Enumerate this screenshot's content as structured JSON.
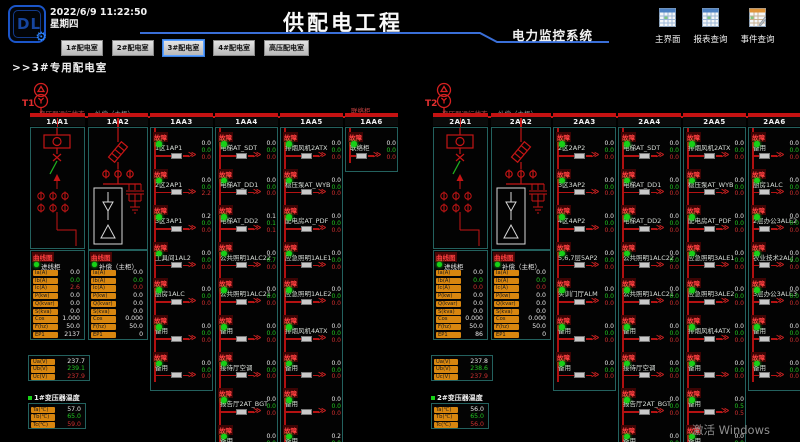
{
  "header": {
    "logo_text": "DL",
    "datetime": "2022/6/9 11:22:50",
    "weekday": "星期四",
    "title": "供配电工程",
    "subtitle": "电力监控系统",
    "nav_buttons": [
      {
        "label": "1#配电室",
        "active": false
      },
      {
        "label": "2#配电室",
        "active": false
      },
      {
        "label": "3#配电室",
        "active": true
      },
      {
        "label": "4#配电室",
        "active": false
      },
      {
        "label": "高压配电室",
        "active": false
      }
    ],
    "tool_buttons": [
      {
        "label": "主界面",
        "icon": "spreadsheet"
      },
      {
        "label": "报表查询",
        "icon": "spreadsheet"
      },
      {
        "label": "事件查询",
        "icon": "event-log"
      }
    ]
  },
  "breadcrumb": ">>3#专用配电室",
  "watermark": "激活 Windows",
  "status_labels": {
    "fault": "故障",
    "curve": "曲线图"
  },
  "value_colors": [
    "#e8e8e8",
    "#21c821",
    "#d03030"
  ],
  "accent_colors": {
    "bus_red": "#c41515",
    "panel_border": "#23615e",
    "label_orange": "#d8860f",
    "header_blue": "#3a6fd8"
  },
  "panels": [
    {
      "name": "T1",
      "labels": {
        "incoming": "变压器运行状态",
        "compensation": "补偿（主柜）",
        "tie": "联络柜"
      },
      "columns": [
        {
          "id": "1AA1",
          "type": "diagram-incoming"
        },
        {
          "id": "1AA2",
          "type": "diagram-compensation"
        },
        {
          "id": "1AA3",
          "type": "feeders",
          "rows": [
            {
              "label": "1区1AP1",
              "values": [
                "0.0",
                "0.0",
                "0.0"
              ]
            },
            {
              "label": "2区2AP1",
              "values": [
                "0.0",
                "0.0",
                "2.2"
              ]
            },
            {
              "label": "3区3AP1",
              "values": [
                "0.2",
                "0.0",
                "0.0"
              ]
            },
            {
              "label": "工具间1AL2",
              "values": [
                "0.0",
                "0.0",
                "0.0"
              ]
            },
            {
              "label": "厨房1ALC",
              "values": [
                "0.0",
                "0.0",
                "0.0"
              ]
            },
            {
              "label": "备用",
              "values": [
                "0.0",
                "0.0",
                "0.0"
              ]
            },
            {
              "label": "备用",
              "values": [
                "0.0",
                "0.0",
                "0.0"
              ]
            }
          ]
        },
        {
          "id": "1AA4",
          "type": "feeders",
          "rows": [
            {
              "label": "电梯AT_SDT",
              "values": [
                "0.0",
                "0.0",
                "0.0"
              ]
            },
            {
              "label": "电梯AT_DD1",
              "values": [
                "0.0",
                "0.0",
                "0.0"
              ]
            },
            {
              "label": "电梯AT_DD2",
              "values": [
                "0.1",
                "0.1",
                "0.1"
              ]
            },
            {
              "label": "公共照明1ALC22",
              "values": [
                "0.0",
                "0.7",
                "0.0"
              ]
            },
            {
              "label": "公共照明1ALC21",
              "values": [
                "0.0",
                "0.0",
                "0.0"
              ]
            },
            {
              "label": "备用",
              "values": [
                "0.0",
                "0.0",
                "0.0"
              ]
            },
            {
              "label": "接待厅空调",
              "values": [
                "0.0",
                "0.0",
                "0.0"
              ]
            },
            {
              "label": "报告厅2AT_BGT",
              "values": [
                "0.0",
                "0.0",
                "0.0"
              ]
            },
            {
              "label": "备用",
              "values": [
                "0.0",
                "0.0",
                "0.0"
              ]
            }
          ]
        },
        {
          "id": "1AA5",
          "type": "feeders",
          "rows": [
            {
              "label": "排烟风机2ATX",
              "values": [
                "0.0",
                "0.0",
                "0.0"
              ]
            },
            {
              "label": "稳压泵AT_WYB",
              "values": [
                "0.0",
                "0.0",
                "0.0"
              ]
            },
            {
              "label": "配电房AT_PDF",
              "values": [
                "0.0",
                "0.0",
                "0.0"
              ]
            },
            {
              "label": "应急照明1ALE1",
              "values": [
                "0.0",
                "0.0",
                "0.0"
              ]
            },
            {
              "label": "应急照明1ALE2",
              "values": [
                "0.0",
                "0.0",
                "0.0"
              ]
            },
            {
              "label": "排烟风机4ATX",
              "values": [
                "0.0",
                "0.0",
                "0.0"
              ]
            },
            {
              "label": "备用",
              "values": [
                "0.0",
                "0.0",
                "0.0"
              ]
            },
            {
              "label": "备用",
              "values": [
                "0.0",
                "0.0",
                "0.0"
              ]
            },
            {
              "label": "备用",
              "values": [
                "0.2",
                "0.0",
                "0.0"
              ]
            }
          ]
        },
        {
          "id": "1AA6",
          "type": "feeders",
          "rows": [
            {
              "label": "联络柜",
              "values": [
                "0.0",
                "0.0",
                "0.0"
              ]
            }
          ]
        }
      ],
      "meters": [
        {
          "name": "进线柜",
          "rows": [
            [
              "Ia(A)",
              "0.0"
            ],
            [
              "Ib(A)",
              "0.0"
            ],
            [
              "Ic(A)",
              "2.6"
            ],
            [
              "P(kw)",
              "0.0"
            ],
            [
              "Q(kvar)",
              "0.0"
            ],
            [
              "S(kva)",
              "0.0"
            ],
            [
              "Cos",
              "1.000"
            ],
            [
              "F(hz)",
              "50.0"
            ],
            [
              "EP1",
              "2137"
            ]
          ]
        },
        {
          "name": "补偿（主柜）",
          "rows": [
            [
              "Ia(A)",
              "0.0"
            ],
            [
              "Ib(A)",
              "0.0"
            ],
            [
              "Ic(A)",
              "0.0"
            ],
            [
              "P(kw)",
              "0.0"
            ],
            [
              "Q(kvar)",
              "0.0"
            ],
            [
              "S(kva)",
              "0.0"
            ],
            [
              "Cos",
              "0.000"
            ],
            [
              "F(hz)",
              "50.0"
            ],
            [
              "EP1",
              "0"
            ]
          ]
        }
      ],
      "voltage": [
        [
          "Ua(V)",
          "237.7"
        ],
        [
          "Ub(V)",
          "239.1"
        ],
        [
          "Uc(V)",
          "237.9"
        ]
      ],
      "temperature": {
        "label": "1#变压器温度",
        "rows": [
          [
            "Ta(℃)",
            "57.0"
          ],
          [
            "Tb(℃)",
            "65.0"
          ],
          [
            "Tc(℃)",
            "59.0"
          ]
        ]
      }
    },
    {
      "name": "T2",
      "labels": {
        "incoming": "变压器运行状态",
        "compensation": "补偿（主柜）",
        "tie": ""
      },
      "columns": [
        {
          "id": "2AA1",
          "type": "diagram-incoming"
        },
        {
          "id": "2AA2",
          "type": "diagram-compensation"
        },
        {
          "id": "2AA3",
          "type": "feeders",
          "rows": [
            {
              "label": "2区2AP2",
              "values": [
                "0.0",
                "0.0",
                "0.0"
              ]
            },
            {
              "label": "3区3AP2",
              "values": [
                "0.0",
                "0.0",
                "0.0"
              ]
            },
            {
              "label": "4区4AP2",
              "values": [
                "0.0",
                "0.0",
                "0.0"
              ]
            },
            {
              "label": "5,6,7层5AP2",
              "values": [
                "0.0",
                "0.0",
                "0.0"
              ]
            },
            {
              "label": "实训门厅ALM",
              "values": [
                "0.0",
                "0.0",
                "0.0"
              ]
            },
            {
              "label": "备用",
              "values": [
                "0.0",
                "0.0",
                "0.0"
              ]
            },
            {
              "label": "备用",
              "values": [
                "0.0",
                "0.0",
                "0.0"
              ]
            }
          ]
        },
        {
          "id": "2AA4",
          "type": "feeders",
          "rows": [
            {
              "label": "电梯AT_SDT",
              "values": [
                "0.0",
                "0.0",
                "0.0"
              ]
            },
            {
              "label": "电梯AT_DD1",
              "values": [
                "0.0",
                "0.0",
                "0.0"
              ]
            },
            {
              "label": "电梯AT_DD2",
              "values": [
                "0.0",
                "0.0",
                "0.0"
              ]
            },
            {
              "label": "公共照明1ALC22",
              "values": [
                "0.0",
                "0.0",
                "0.0"
              ]
            },
            {
              "label": "公共照明1ALC21",
              "values": [
                "0.0",
                "0.0",
                "0.0"
              ]
            },
            {
              "label": "备用",
              "values": [
                "0.0",
                "0.0",
                "0.0"
              ]
            },
            {
              "label": "接待厅空调",
              "values": [
                "0.0",
                "0.0",
                "0.0"
              ]
            },
            {
              "label": "报告厅2AT_BGT",
              "values": [
                "0.0",
                "0.0",
                "0.0"
              ]
            },
            {
              "label": "备用",
              "values": [
                "0.0",
                "0.0",
                "0.0"
              ]
            }
          ]
        },
        {
          "id": "2AA5",
          "type": "feeders",
          "rows": [
            {
              "label": "排烟风机2ATX",
              "values": [
                "0.0",
                "0.0",
                "0.0"
              ]
            },
            {
              "label": "稳压泵AT_WYB",
              "values": [
                "0.0",
                "0.0",
                "0.0"
              ]
            },
            {
              "label": "配电房AT_PDF",
              "values": [
                "0.0",
                "0.0",
                "0.0"
              ]
            },
            {
              "label": "应急照明3ALE1",
              "values": [
                "0.0",
                "0.0",
                "0.0"
              ]
            },
            {
              "label": "应急照明3ALE2",
              "values": [
                "0.0",
                "0.0",
                "0.0"
              ]
            },
            {
              "label": "排烟风机4ATX",
              "values": [
                "0.0",
                "0.0",
                "0.0"
              ]
            },
            {
              "label": "备用",
              "values": [
                "0.0",
                "0.0",
                "0.0"
              ]
            },
            {
              "label": "备用",
              "values": [
                "0.0",
                "0.5",
                "0.5"
              ]
            },
            {
              "label": "备用",
              "values": [
                "0.0",
                "0.0",
                "0.0"
              ]
            }
          ]
        },
        {
          "id": "2AA6",
          "type": "feeders",
          "rows": [
            {
              "label": "备用",
              "values": [
                "0.0",
                "0.0",
                "0.0"
              ]
            },
            {
              "label": "厨房1ALC",
              "values": [
                "0.0",
                "0.0",
                "0.0"
              ]
            },
            {
              "label": "2层办公3ALE2",
              "values": [
                "0.0",
                "0.0",
                "0.0"
              ]
            },
            {
              "label": "农业技术2ALJ",
              "values": [
                "0.0",
                "0.0",
                "0.0"
              ]
            },
            {
              "label": "3层办公3ALE3",
              "values": [
                "0.0",
                "0.0",
                "0.0"
              ]
            },
            {
              "label": "备用",
              "values": [
                "0.0",
                "0.0",
                "0.0"
              ]
            },
            {
              "label": "备用",
              "values": [
                "0.0",
                "0.0",
                "0.0"
              ]
            }
          ]
        }
      ],
      "meters": [
        {
          "name": "进线柜",
          "rows": [
            [
              "Ia(A)",
              "0.0"
            ],
            [
              "Ib(A)",
              "0.0"
            ],
            [
              "Ic(A)",
              "0.0"
            ],
            [
              "P(kw)",
              "0.0"
            ],
            [
              "Q(kvar)",
              "0.0"
            ],
            [
              "S(kva)",
              "0.0"
            ],
            [
              "Cos",
              "0.000"
            ],
            [
              "F(hz)",
              "50.0"
            ],
            [
              "EP1",
              "86"
            ]
          ]
        },
        {
          "name": "补偿（主柜）",
          "rows": [
            [
              "Ia(A)",
              "0.0"
            ],
            [
              "Ib(A)",
              "0.0"
            ],
            [
              "Ic(A)",
              "0.0"
            ],
            [
              "P(kw)",
              "0.0"
            ],
            [
              "Q(kvar)",
              "0.0"
            ],
            [
              "S(kva)",
              "0.0"
            ],
            [
              "Cos",
              "0.000"
            ],
            [
              "F(hz)",
              "50.0"
            ],
            [
              "EP1",
              "0"
            ]
          ]
        }
      ],
      "voltage": [
        [
          "Ua(V)",
          "237.8"
        ],
        [
          "Ub(V)",
          "238.6"
        ],
        [
          "Uc(V)",
          "237.9"
        ]
      ],
      "temperature": {
        "label": "2#变压器温度",
        "rows": [
          [
            "Ta(℃)",
            "56.0"
          ],
          [
            "Tb(℃)",
            "65.0"
          ],
          [
            "Tc(℃)",
            "56.0"
          ]
        ]
      }
    }
  ]
}
